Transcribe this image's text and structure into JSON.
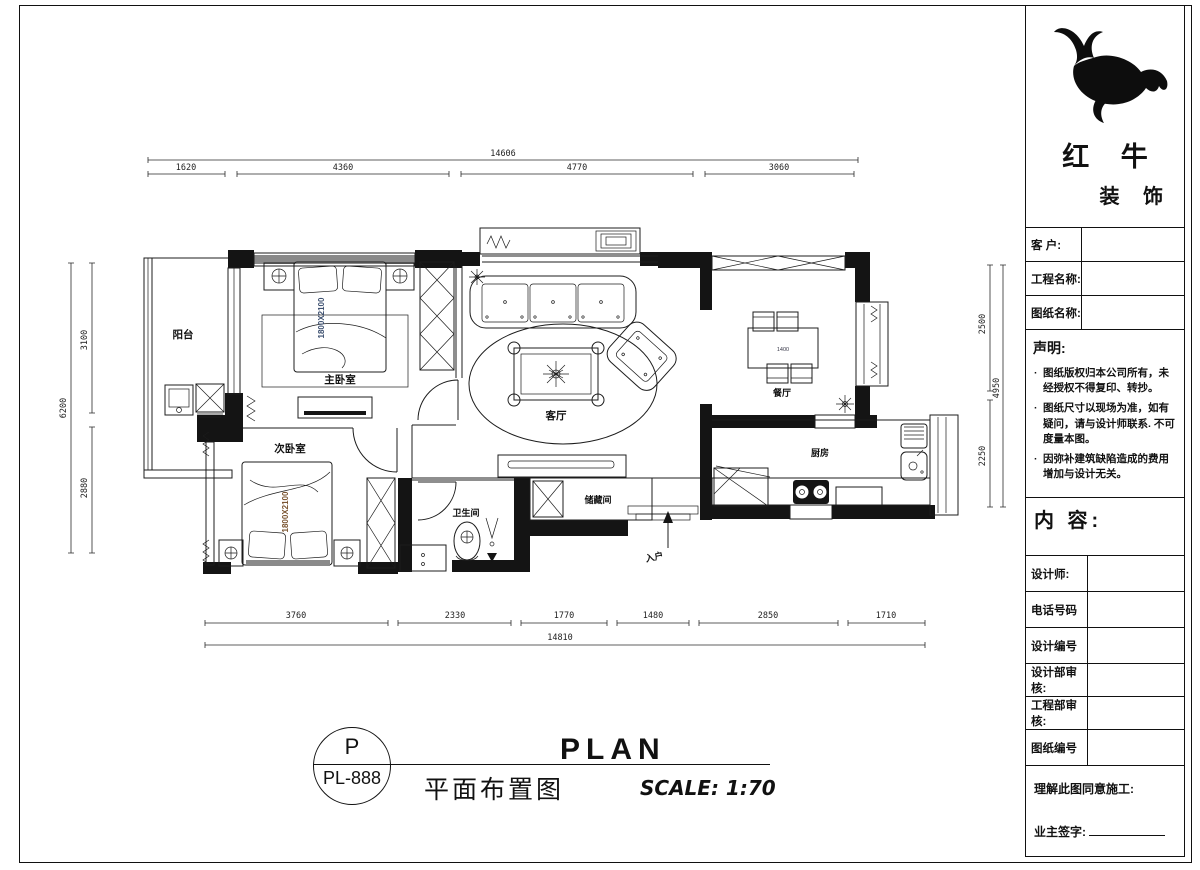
{
  "sheet": {
    "bg": "#ffffff",
    "line_color": "#1a1a1a"
  },
  "brand": {
    "name_top": "红 牛",
    "name_bottom": "装 饰",
    "logo_icon": "bull-logo"
  },
  "title_block": {
    "customer_label": "客  户:",
    "project_label": "工程名称:",
    "drawing_label": "图纸名称:",
    "statement_heading": "声明:",
    "statement_items": [
      "图纸版权归本公司所有，未经授权不得复印、转抄。",
      "图纸尺寸以现场为准，如有疑问，请与设计师联系. 不可度量本图。",
      "因弥补建筑缺陷造成的费用增加与设计无关。"
    ],
    "content_label": "内 容:",
    "designer_label": "设计师:",
    "phone_label": "电话号码",
    "design_no_label": "设计编号",
    "design_review_label": "设计部审核:",
    "eng_review_label": "工程部审核:",
    "drawing_no_label": "图纸编号",
    "agree_line": "理解此图同意施工:",
    "owner_sign_label": "业主签字:"
  },
  "title_bar": {
    "bubble_top": "P",
    "bubble_bottom": "PL-888",
    "title_cn": "平面布置图",
    "title_en": "PLAN",
    "scale_text": "SCALE: 1:70"
  },
  "rooms": {
    "balcony": "阳台",
    "master_bedroom": "主卧室",
    "second_bedroom": "次卧室",
    "living_room": "客厅",
    "dining_room": "餐厅",
    "kitchen": "厨房",
    "bathroom": "卫生间",
    "storage": "储藏间",
    "entry": "入户"
  },
  "furniture": {
    "master_bed_size": "1800X2100",
    "second_bed_size": "1800X2100",
    "dining_table_size": "1400"
  },
  "dimensions": {
    "top": {
      "overall": "14606",
      "segments": [
        "1620",
        "4360",
        "4770",
        "3060"
      ]
    },
    "bottom": {
      "overall": "14810",
      "segments": [
        "3760",
        "2330",
        "1770",
        "1480",
        "2850",
        "1710"
      ]
    },
    "left": {
      "overall": "6200",
      "segments": [
        "3100",
        "2880"
      ]
    },
    "right": {
      "overall": "4950",
      "segments": [
        "2500",
        "2250"
      ]
    }
  },
  "colors": {
    "master_bed_label": "#3d5070",
    "second_bed_label": "#7a5430",
    "dim_text": "#222222"
  }
}
